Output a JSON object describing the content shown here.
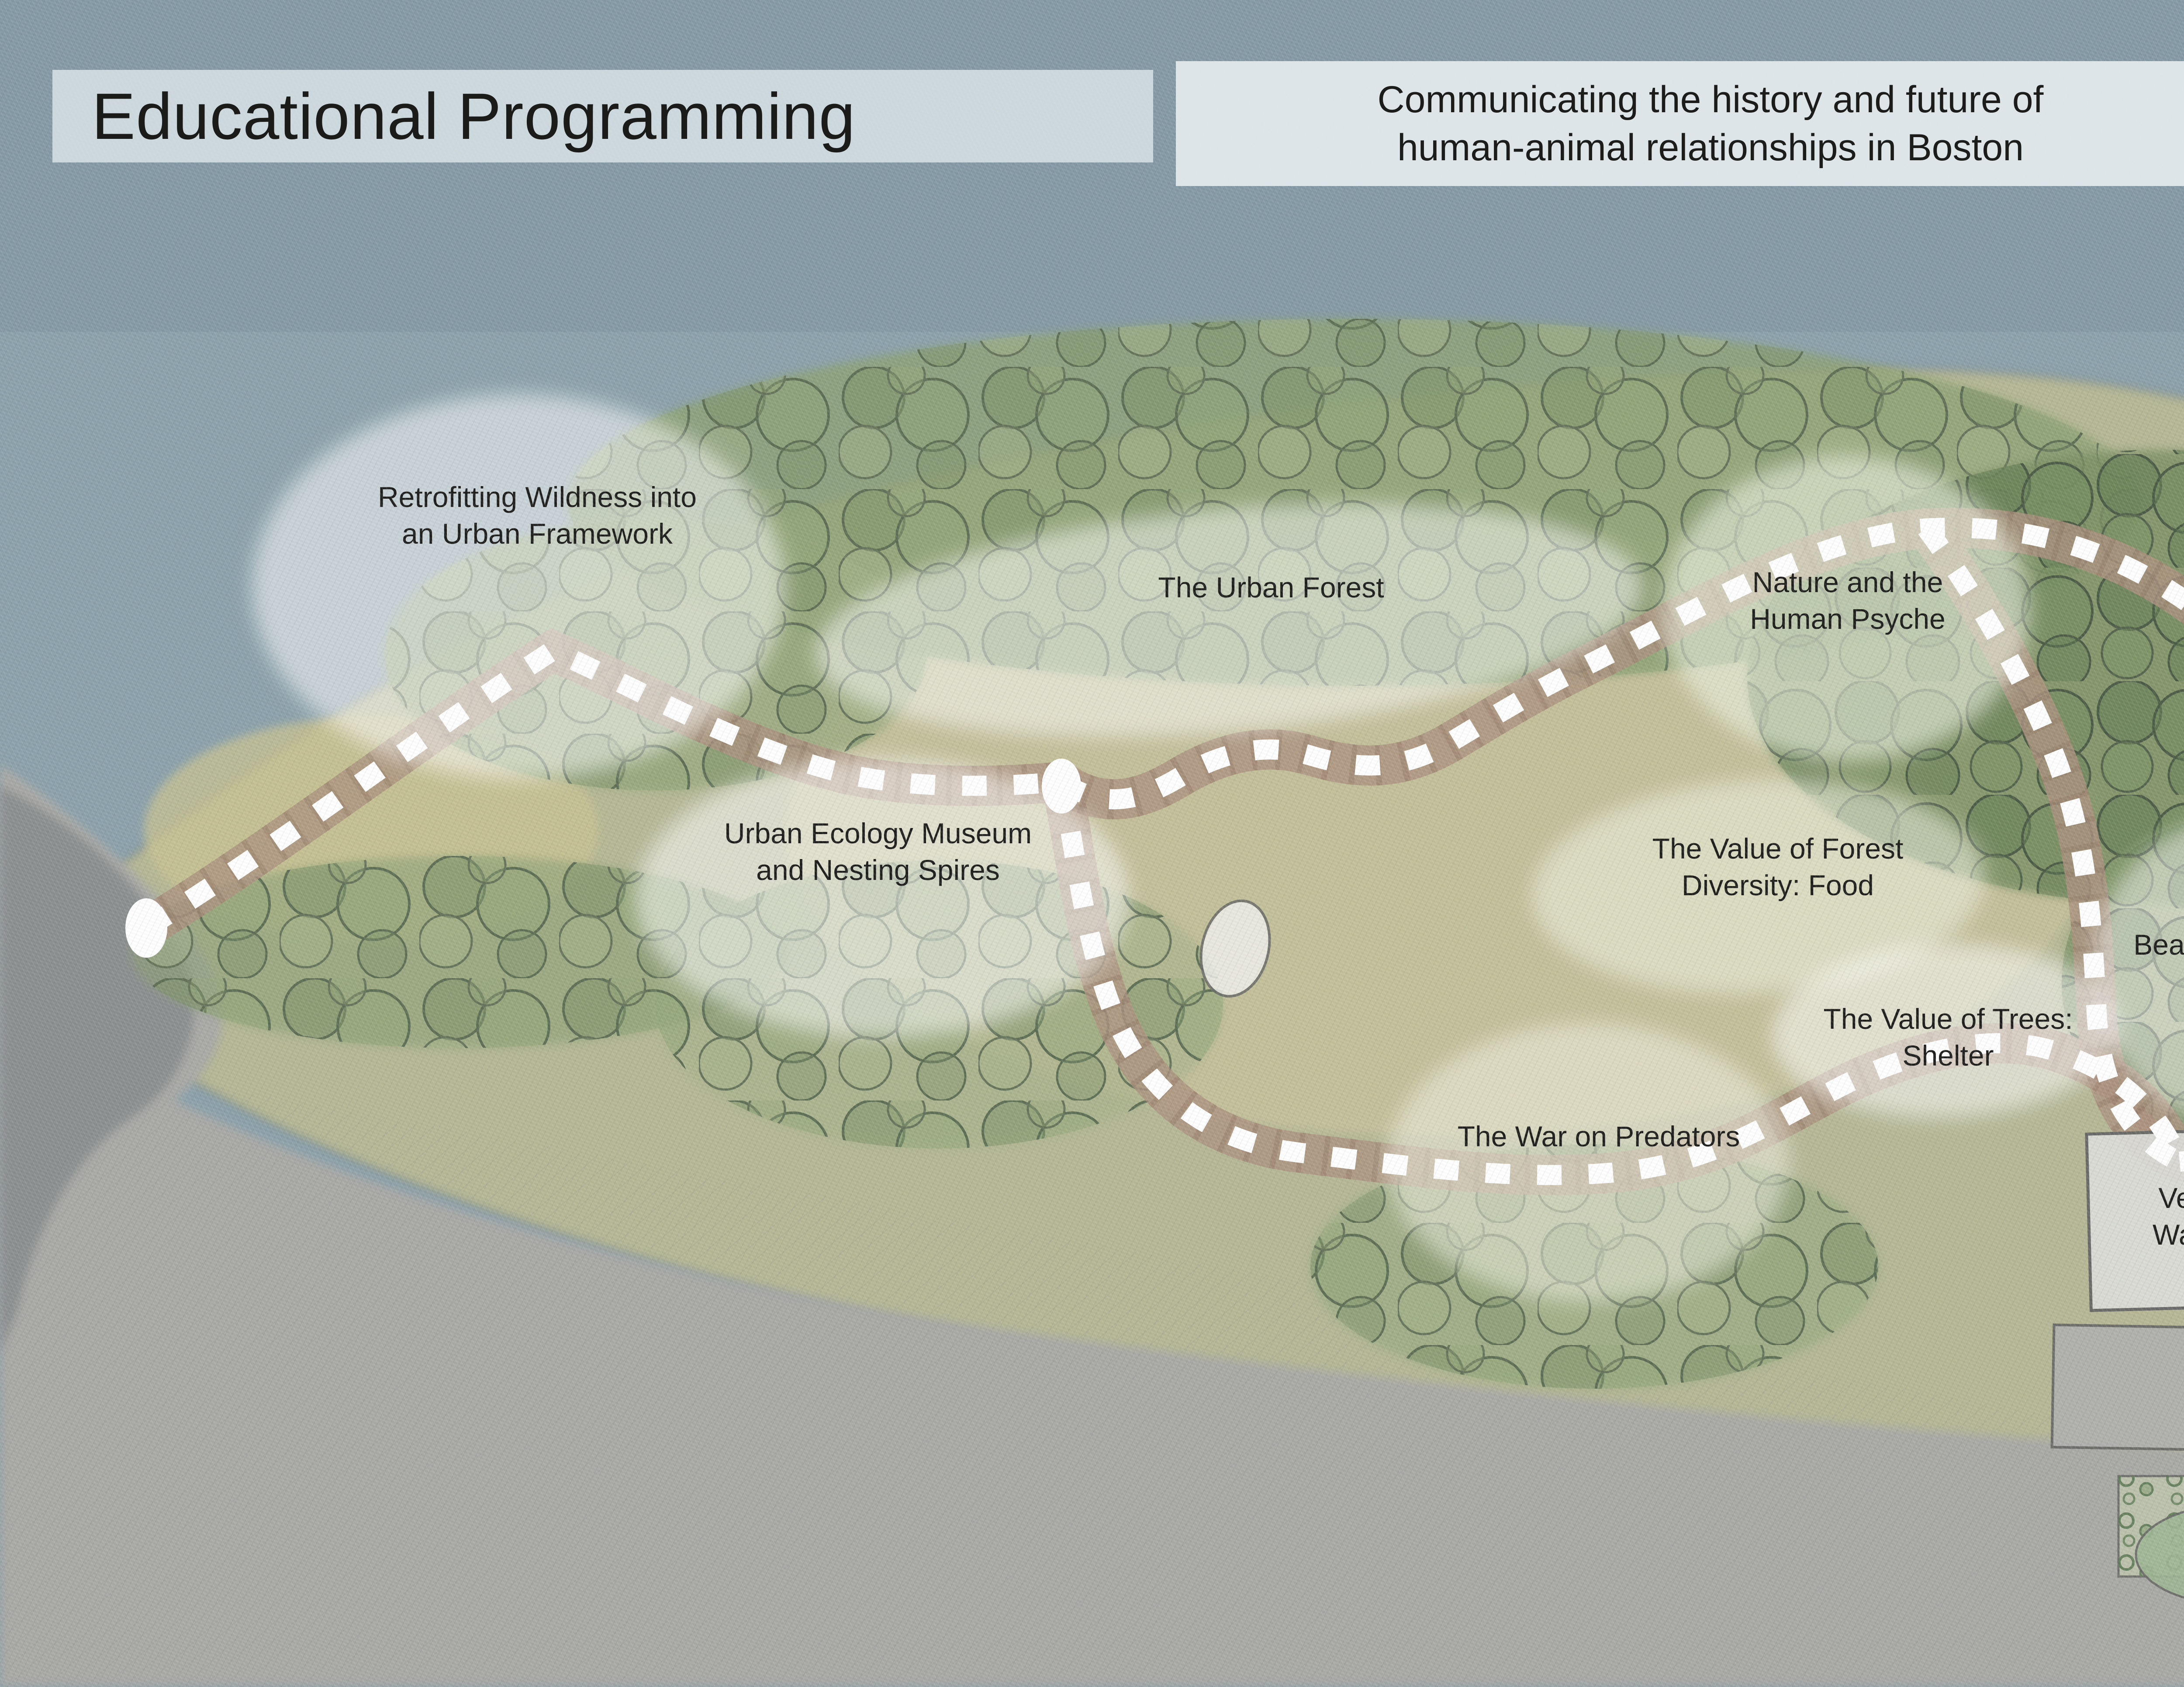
{
  "header": {
    "title": "Educational Programming",
    "subtitle": "Communicating the history and future of\nhuman-animal relationships in Boston"
  },
  "stations": [
    {
      "id": "retrofitting-wildness",
      "label": "Retrofitting Wildness into\nan Urban Framework"
    },
    {
      "id": "urban-forest",
      "label": "The Urban Forest"
    },
    {
      "id": "nature-human-psyche",
      "label": "Nature and the\nHuman Psyche"
    },
    {
      "id": "urban-ecology-museum",
      "label": "Urban Ecology Museum\nand Nesting Spires"
    },
    {
      "id": "forest-diversity-food",
      "label": "The Value of Forest\nDiversity: Food"
    },
    {
      "id": "beavers-ecosystem-engineers",
      "label": "Beavers: Ecosystem\nEngineers"
    },
    {
      "id": "revegetating-urban-rivers",
      "label": "Re-vegetating\nUrban Rivers"
    },
    {
      "id": "value-of-trees-shelter",
      "label": "The Value of Trees:\nShelter"
    },
    {
      "id": "war-on-predators",
      "label": "The War on Predators"
    },
    {
      "id": "vegetated-waterways",
      "label": "Vegetated\nWaterways"
    },
    {
      "id": "old-estuaries-boston-harbor",
      "label": "Old Estuaries of\nBoston Harbor"
    }
  ],
  "map": {
    "trail": {
      "style": "white dashed walking loop over brown boardwalk",
      "node_count": 6,
      "dash_color": "#FFFFFF",
      "underlay_color": "#AD9280"
    },
    "colors": {
      "water": "#8CA1AB",
      "land_olive": "#B5B795",
      "forest_green": "#7E9268",
      "urban_gray": "#A9A9A6",
      "slope_brown": "#B29379",
      "header_band": "#DDE4E7",
      "text": "#1D1D1B",
      "station_bubble": "#FFFFFF"
    }
  }
}
